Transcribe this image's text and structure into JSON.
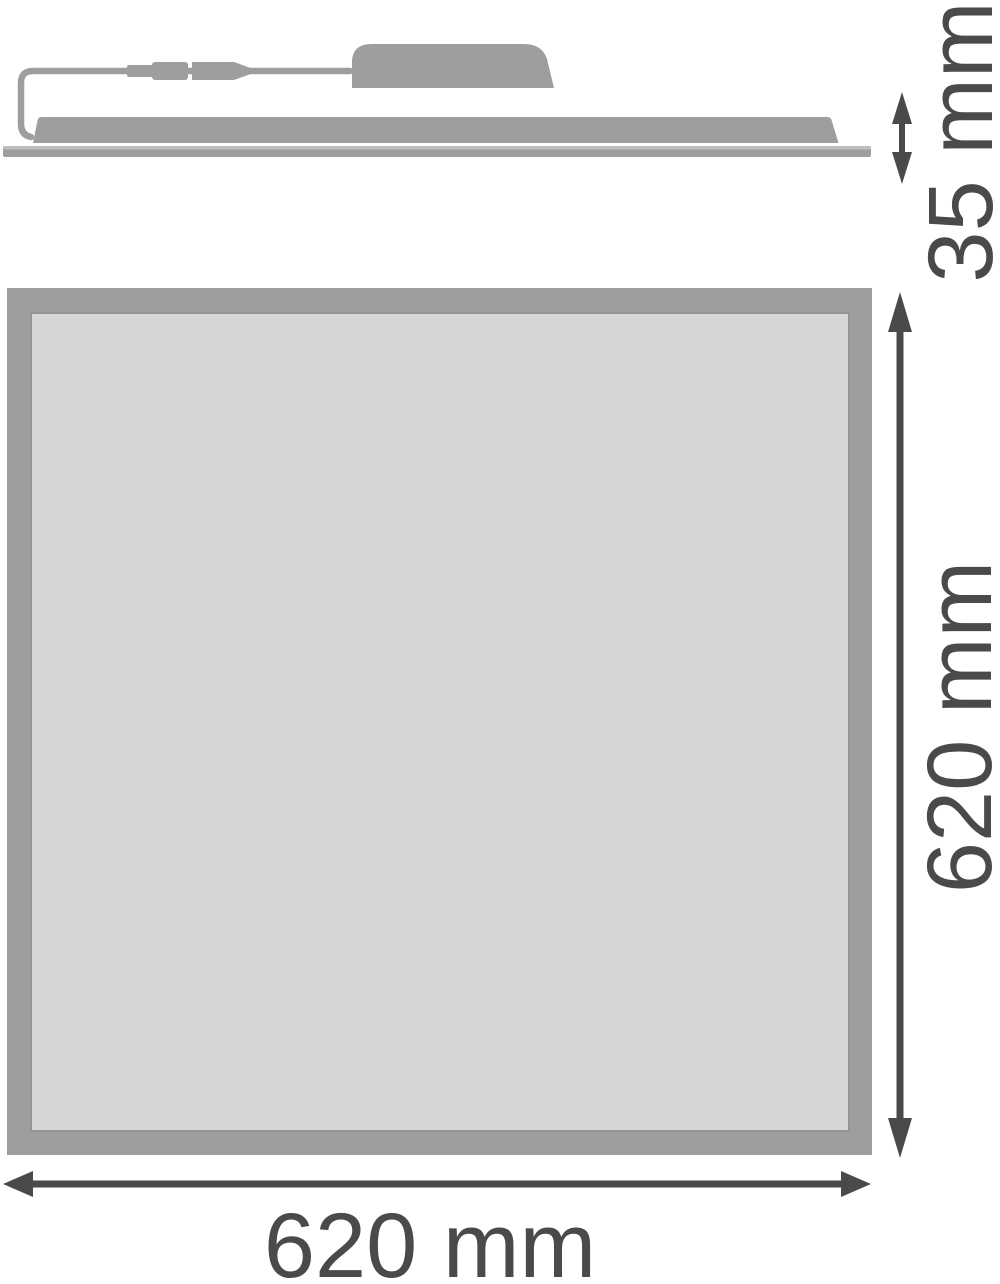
{
  "dimensions": {
    "side_height": "35 mm",
    "front_height": "620 mm",
    "front_width": "620 mm"
  },
  "icons": {
    "side_height_arrow": "double-arrow-vertical",
    "front_height_arrow": "double-arrow-vertical",
    "front_width_arrow": "double-arrow-horizontal"
  },
  "colors": {
    "shape": "#9c9ea0",
    "panel_face": "#d5d6d8",
    "frame_inner_line": "#939597",
    "plate_highlight": "#bcbec0",
    "dimension": "#4a4a4c",
    "background": "#ffffff"
  }
}
